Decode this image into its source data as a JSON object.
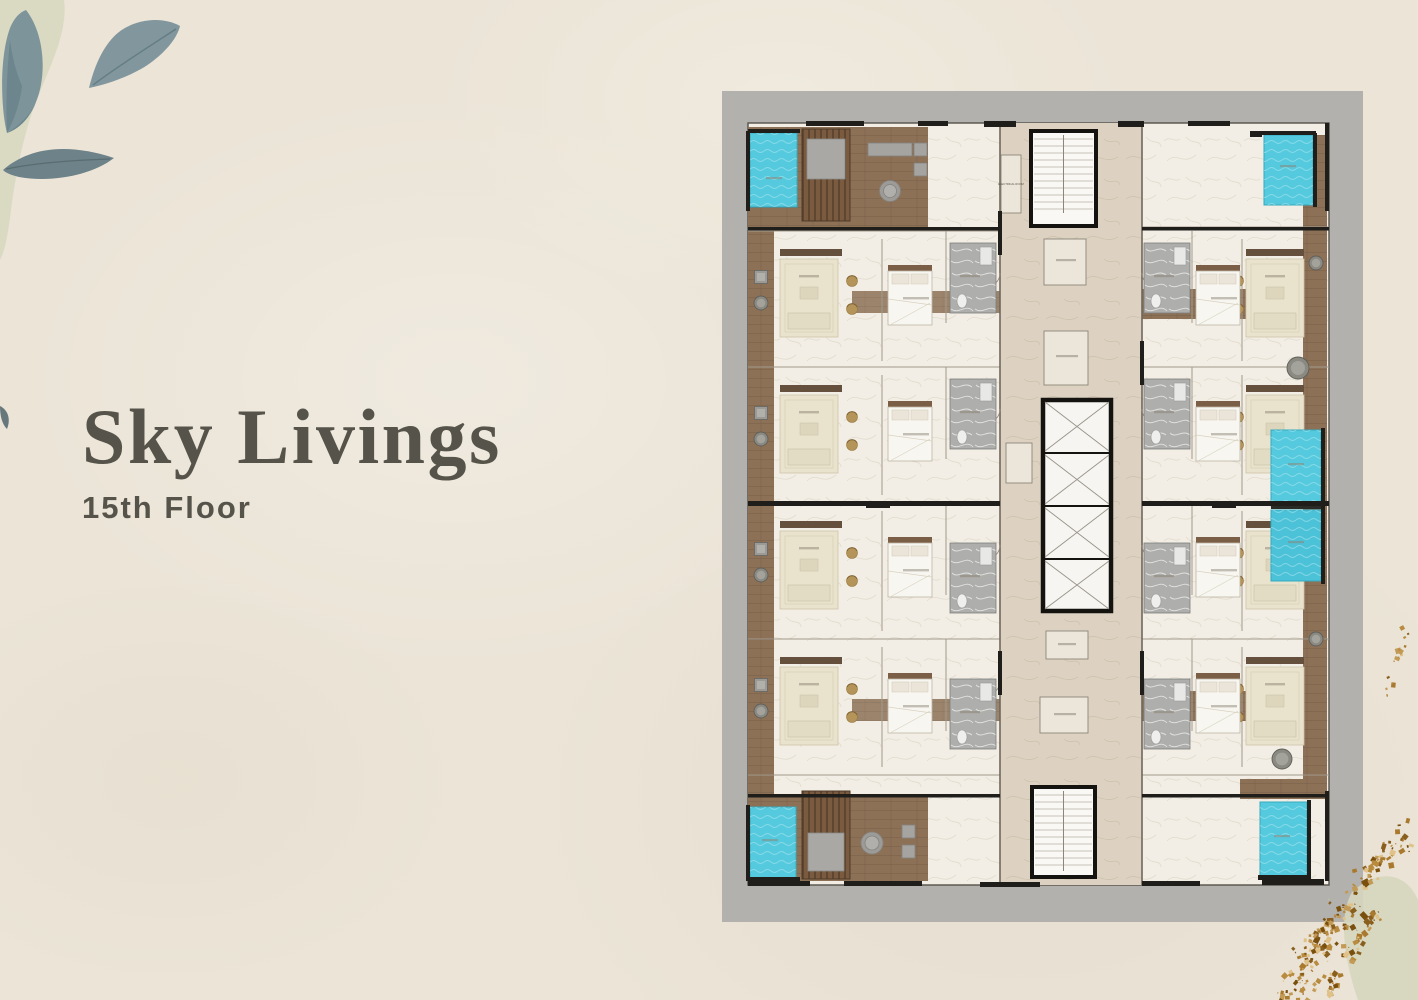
{
  "hero": {
    "title": "Sky Livings",
    "subtitle": "15th Floor"
  },
  "floor_plan": {
    "labels": {
      "electrical_room": "ELECTRICAL ROOM"
    }
  },
  "colors": {
    "background": "#ebe4d7",
    "title_text": "#56544a",
    "plan_frame": "#b3b1ae",
    "pool_water": "#55cade",
    "wood_deck": "#8d7157",
    "pergola_slats": "#7a5b40",
    "marble_floor": "#f2eee5",
    "corridor_floor": "#ddd2c1",
    "rug_cream": "#e9e3cd",
    "accent_tan": "#b5945a",
    "wall_dark": "#22211e",
    "leaf_blue_gray": "#7e949b",
    "sage_wash": "#d8d8c1",
    "gold_speckles": [
      "#a97a2e",
      "#c29a55",
      "#8a5f1e",
      "#e0c289",
      "#b98b3f",
      "#7a500f"
    ]
  }
}
